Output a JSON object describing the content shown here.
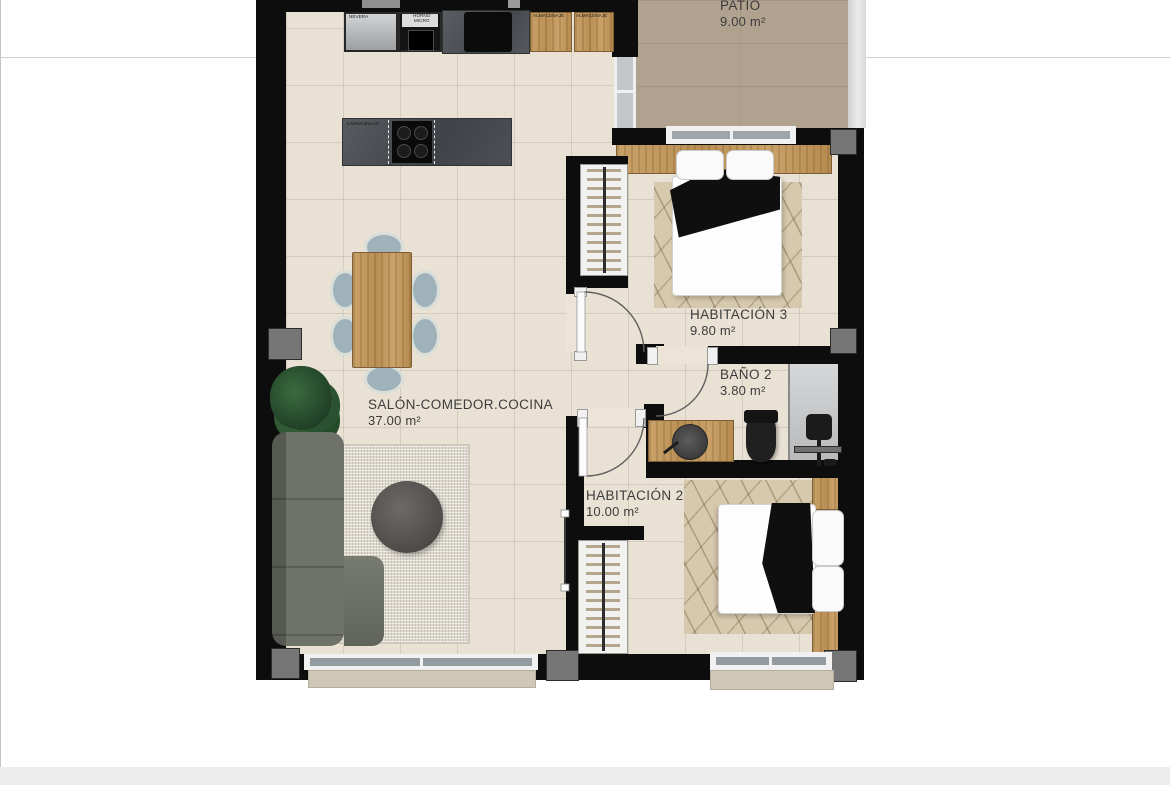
{
  "plan": {
    "title": "apartment-floor-plan",
    "rooms": {
      "patio": {
        "label": "PATIO",
        "area": "9.00 m²"
      },
      "habitacion3": {
        "label": "HABITACIÓN 3",
        "area": "9.80 m²"
      },
      "bano2": {
        "label": "BAÑO 2",
        "area": "3.80 m²"
      },
      "habitacion2": {
        "label": "HABITACIÓN 2",
        "area": "10.00 m²"
      },
      "salon": {
        "label": "SALÓN-COMEDOR.COCINA",
        "area": "37.00 m²"
      }
    },
    "kitchen": {
      "fridge": "NEVERA",
      "oven_line1": "HORNO",
      "oven_line2": "MICRO",
      "storage1": "ALMACENAJE",
      "storage2": "ALMACENAJE",
      "dishwasher": "LAVAVAJILLAS"
    },
    "colors": {
      "wall": "#0d0d0d",
      "floor_tile": "#e9e1d4",
      "patio_deck": "#b1a290",
      "wood": "#c49e62",
      "pillar_gray": "#767676",
      "label_text": "#3c3c3c",
      "shower_gray": "#c9cbcd",
      "sofa_gray": "#6e7268"
    }
  }
}
